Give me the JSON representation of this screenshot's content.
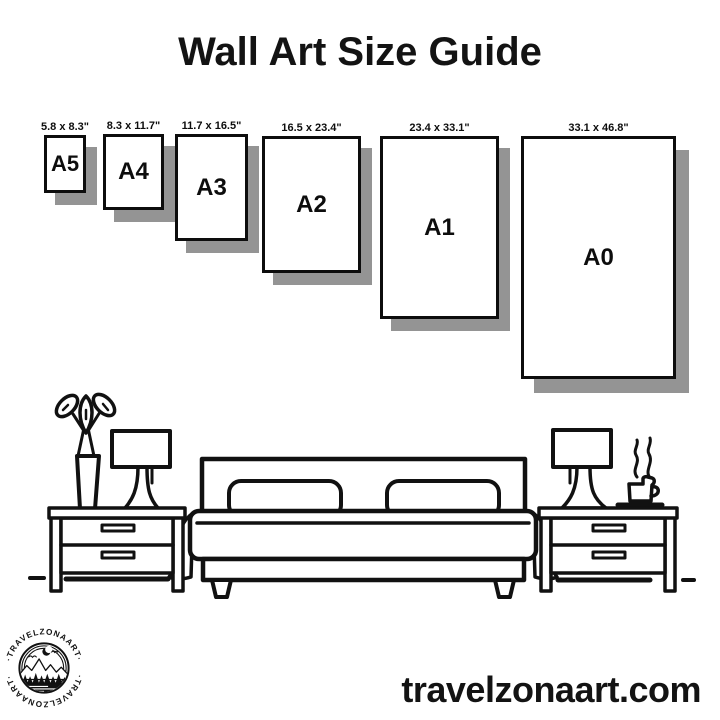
{
  "title": "Wall Art Size Guide",
  "sizes": [
    {
      "name": "A5",
      "dimensions": "5.8 x 8.3\""
    },
    {
      "name": "A4",
      "dimensions": "8.3 x 11.7\""
    },
    {
      "name": "A3",
      "dimensions": "11.7 x 16.5\""
    },
    {
      "name": "A2",
      "dimensions": "16.5 x 23.4\""
    },
    {
      "name": "A1",
      "dimensions": "23.4 x 33.1\""
    },
    {
      "name": "A0",
      "dimensions": "33.1 x 46.8\""
    }
  ],
  "illustration": {
    "description": "bedroom line-art: plant vase, two table lamps, two nightstands with drawers, double bed with two pillows, coffee cup with steam",
    "ink_color": "#111111"
  },
  "logo": {
    "arc_text_top": "·TRAVELZONAART·",
    "arc_text_bottom": "·TRAVELZONAART·"
  },
  "website": "travelzonaart.com",
  "colors": {
    "ink": "#111111",
    "shadow": "#949494",
    "background": "#ffffff"
  }
}
